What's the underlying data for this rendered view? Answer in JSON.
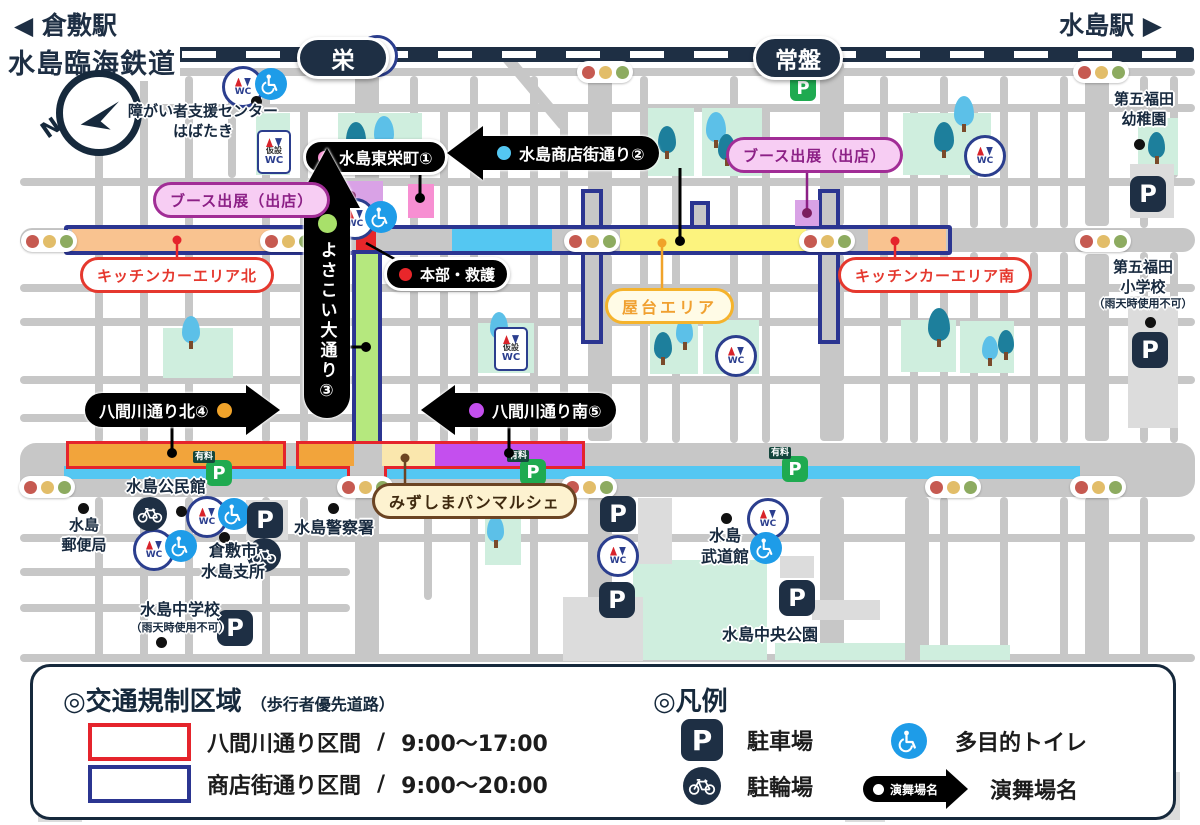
{
  "header": {
    "left_direction": "◀ 倉敷駅",
    "right_direction": "水島駅 ▶",
    "railway_name": "水島臨海鉄道",
    "station_sakae": "栄",
    "station_tokiwa": "常盤",
    "compass_n": "N"
  },
  "venue_labels": {
    "higashisakae": "水島東栄町①",
    "shotengai": "水島商店街通り②",
    "yosakoi": "よさこい大通り③",
    "hachimagawa_north": "八間川通り北④",
    "hachimagawa_south": "八間川通り南⑤",
    "honbu_kyugo": "本部・救護"
  },
  "area_labels": {
    "booth_left": "ブース出展（出店）",
    "booth_right": "ブース出展（出店）",
    "kitchen_car_north": "キッチンカーエリア北",
    "kitchen_car_south": "キッチンカーエリア南",
    "yatai_area": "屋台エリア",
    "pan_marche": "みずしまパンマルシェ"
  },
  "places": {
    "shien_center_line1": "障がい者支援センター",
    "shien_center_line2": "はばたき",
    "yochien_line1": "第五福田",
    "yochien_line2": "幼稚園",
    "shogakko_line1": "第五福田",
    "shogakko_line2": "小学校",
    "shogakko_note": "（雨天時使用不可）",
    "post_office_line1": "水島",
    "post_office_line2": "郵便局",
    "kominkan": "水島公民館",
    "shisho_line1": "倉敷市",
    "shisho_line2": "水島支所",
    "police": "水島警察署",
    "chugakko": "水島中学校",
    "chugakko_note": "（雨天時使用不可）",
    "budokan_line1": "水島",
    "budokan_line2": "武道館",
    "chuo_park": "水島中央公園"
  },
  "icon_text": {
    "wc": "WC",
    "kasetsu": "仮設",
    "paid": "有料",
    "parking": "P"
  },
  "legend": {
    "traffic_title": "◎交通規制区域",
    "traffic_subtitle": "（歩行者優先道路）",
    "row1_label": "八間川通り区間",
    "row1_sep": "/",
    "row1_time": "9:00～17:00",
    "row2_label": "商店街通り区間",
    "row2_sep": "/",
    "row2_time": "9:00～20:00",
    "hanrei_title": "◎凡例",
    "parking_label": "駐車場",
    "bicycle_label": "駐輪場",
    "toilet_label": "多目的トイレ",
    "venue_sample": "演舞場名",
    "venue_label": "演舞場名"
  },
  "colors": {
    "navy": "#1e2f44",
    "regulation_red": "#e5242c",
    "regulation_navy": "#2b3591",
    "shotengai_blue": "#54c7f2",
    "yatai_yellow": "#fcf37e",
    "kitchen_orange": "#f9c390",
    "yosakoi_green": "#b5e87e",
    "hachimagawa_amber": "#f2a43b",
    "marche_cream": "#fae7ad",
    "hachimagawa_purple": "#c44fee",
    "booth_pink_fill": "#f7cdf3",
    "paid_parking_green": "#1faa50",
    "toilet_blue": "#1e9ce8"
  }
}
